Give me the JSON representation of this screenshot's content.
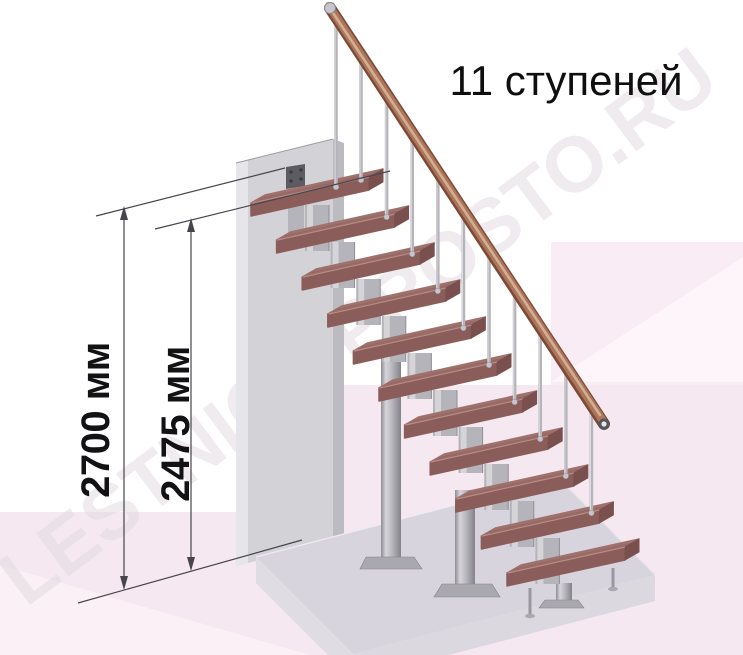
{
  "title": "11 ступеней",
  "watermark": "LESTNICY-PROSTO.RU",
  "dimensions": {
    "total_height_label": "2700 мм",
    "flight_height_label": "2475 мм"
  },
  "staircase": {
    "steps_count": 11,
    "balusters_count": 10,
    "main_columns": 2
  },
  "colors": {
    "step_top": "#9f716c",
    "step_front": "#8b5d5a",
    "step_side": "#7a504e",
    "step_nose": "#c39b93",
    "step_grain": "#7b504d",
    "metal": "#b5b4ba",
    "metal_light": "#e3e2e6",
    "metal_dark": "#8f8e96",
    "rail_dark": "#7e4a38",
    "rail_mid": "#ab765b",
    "rail_light": "#d9b598",
    "wall_front": "#d3d2d7",
    "wall_left": "#e6e5e9",
    "wall_side": "#bcbbc2",
    "mount_plate": "#5c5b61",
    "slab_top": "#d8d4dd",
    "slab_front_left": "#e0dce4",
    "slab_front_right": "#dcd8e0",
    "bg_pink_block": "#f9ecf4",
    "bg_pink_floor": "#f6e8f0",
    "bg_pink_light": "#fdf5fa",
    "dim_line": "#46454b",
    "watermark_color": "#e2dbe1"
  }
}
